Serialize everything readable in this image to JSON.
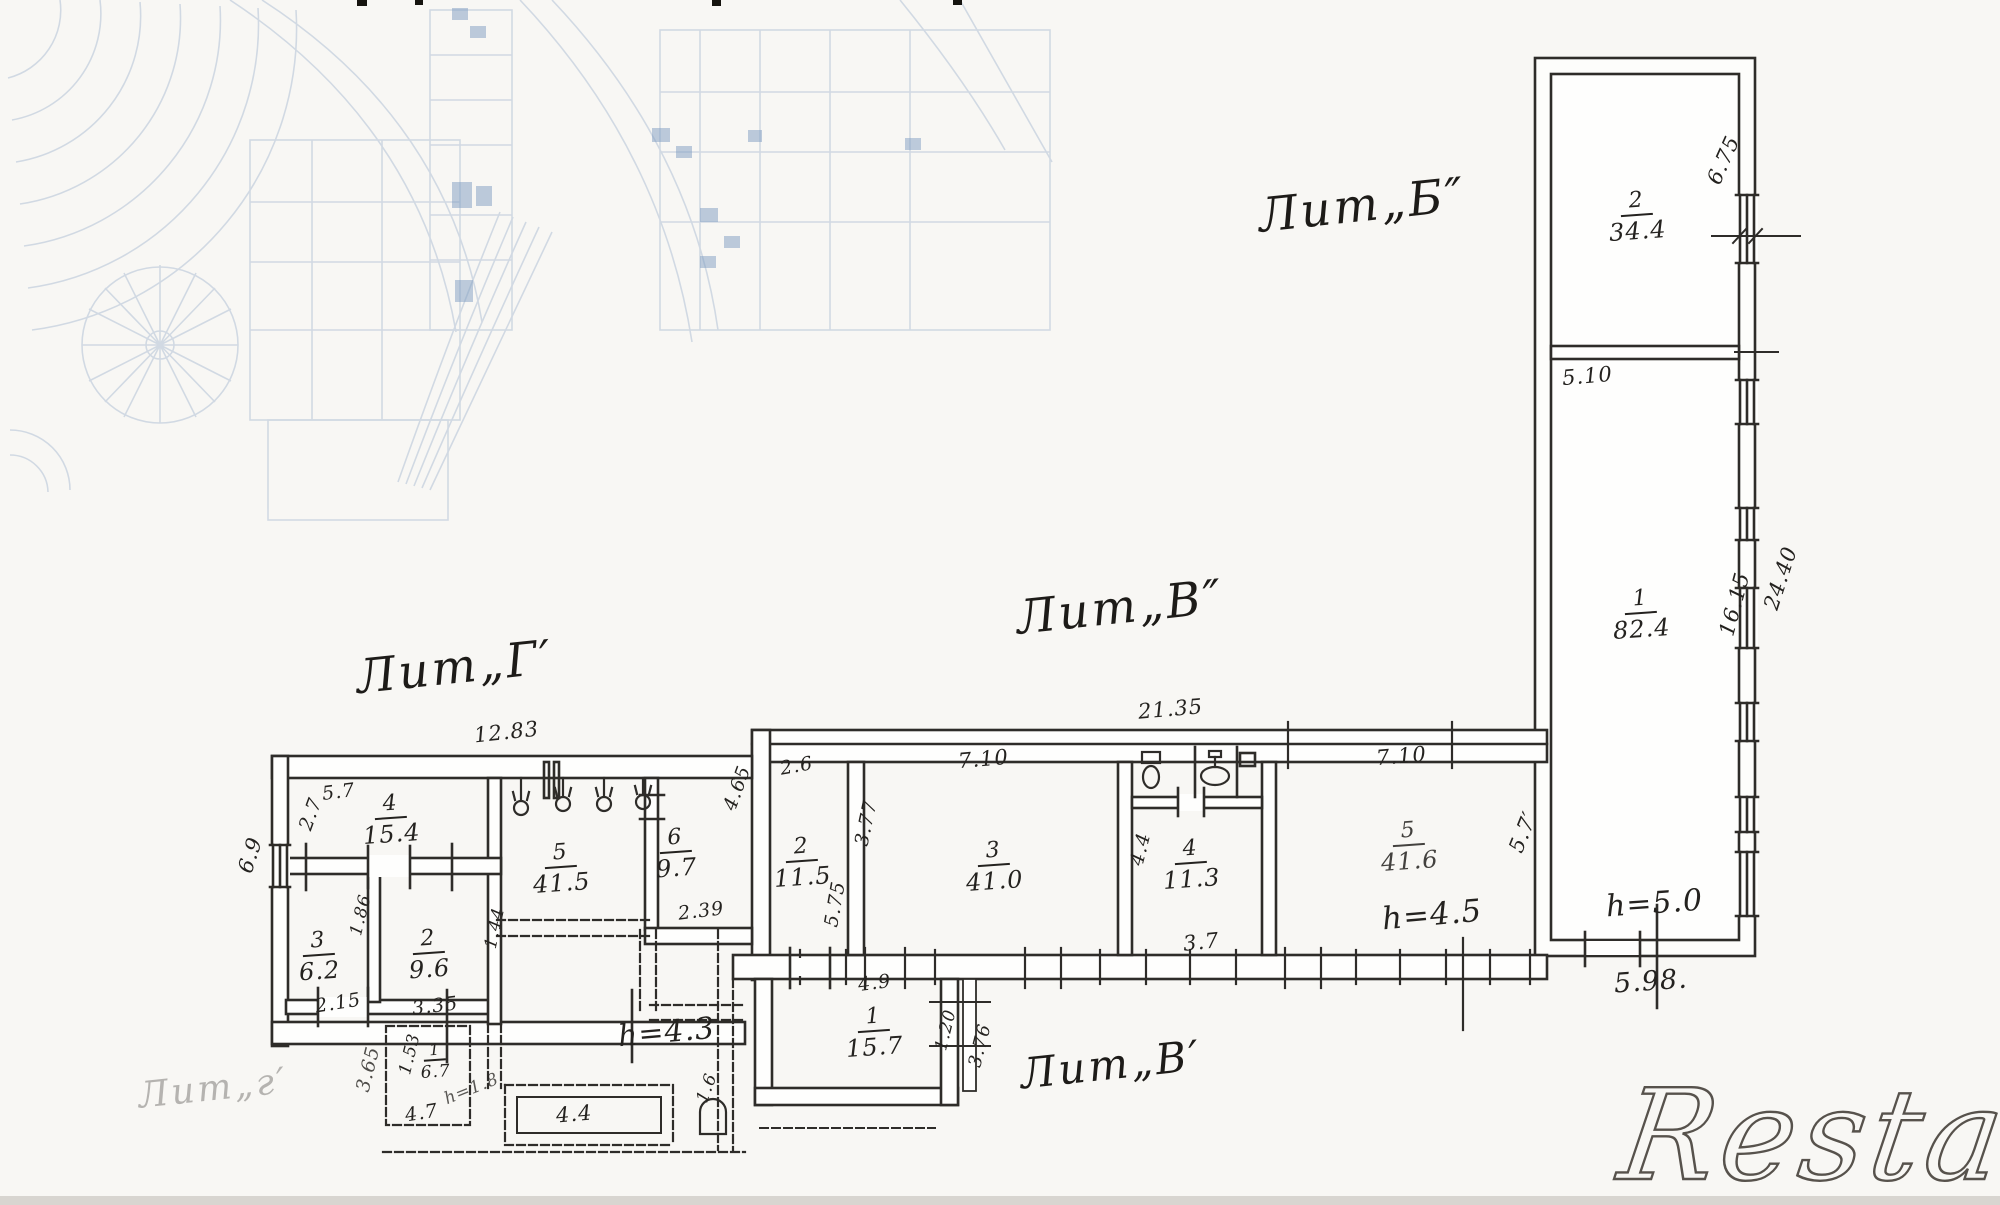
{
  "labels": {
    "lit_b": "Лит„Б″",
    "lit_v": "Лит„В″",
    "lit_v1": "Лит„В′",
    "lit_g": "Лит„Г′",
    "lit_g_faded": "Лит„г′"
  },
  "rooms": [
    {
      "num": "2",
      "area": "34.4"
    },
    {
      "num": "1",
      "area": "82.4"
    },
    {
      "num": "2",
      "area": "11.5"
    },
    {
      "num": "3",
      "area": "41.0"
    },
    {
      "num": "4",
      "area": "11.3"
    },
    {
      "num": "5",
      "area": "41.6"
    },
    {
      "num": "4",
      "area": "15.4"
    },
    {
      "num": "5",
      "area": "41.5"
    },
    {
      "num": "6",
      "area": "9.7"
    },
    {
      "num": "3",
      "area": "6.2"
    },
    {
      "num": "2",
      "area": "9.6"
    },
    {
      "num": "1",
      "area": "15.7"
    },
    {
      "num": "1",
      "area": "6.7"
    }
  ],
  "dims": {
    "b675": "6.75",
    "b510": "5.10",
    "b1615": "16.15",
    "b2440": "24.40",
    "bh50": "h=5.0",
    "b598": "5.98.",
    "v2135": "21.35",
    "v26": "2.6",
    "v710a": "7.10",
    "v377": "3.77",
    "v575": "5.75",
    "v44": "4.4",
    "v37": "3.7",
    "v710b": "7.10",
    "v57": "5.7′",
    "vh45": "h=4.5",
    "g1283": "12.83",
    "g57": "5.7",
    "g27": "2.7",
    "g69": "6.9",
    "g465": "4.65",
    "g239": "2.39",
    "g186": "1.86",
    "g215": "2.15",
    "g335": "3.35",
    "g144": "1.44",
    "gh43": "h=4.3",
    "g153": "1.53",
    "g47": "4.7",
    "gh18": "h=1.8",
    "g365": "3.65",
    "g16": "1.6",
    "g44": "4.4",
    "w49": "4.9",
    "w120": "1.20",
    "w376": "3.76"
  },
  "icons": {
    "toilet": "toilet-icon",
    "sink": "sink-icon",
    "lamp": "lamp-icon",
    "basin": "basin-icon"
  },
  "watermark": {
    "text": "Restate"
  },
  "colors": {
    "ink": "#2e2c29",
    "underlay_blue": "#9db2cc",
    "watermark": "#57524c",
    "paper": "#f8f7f4"
  }
}
